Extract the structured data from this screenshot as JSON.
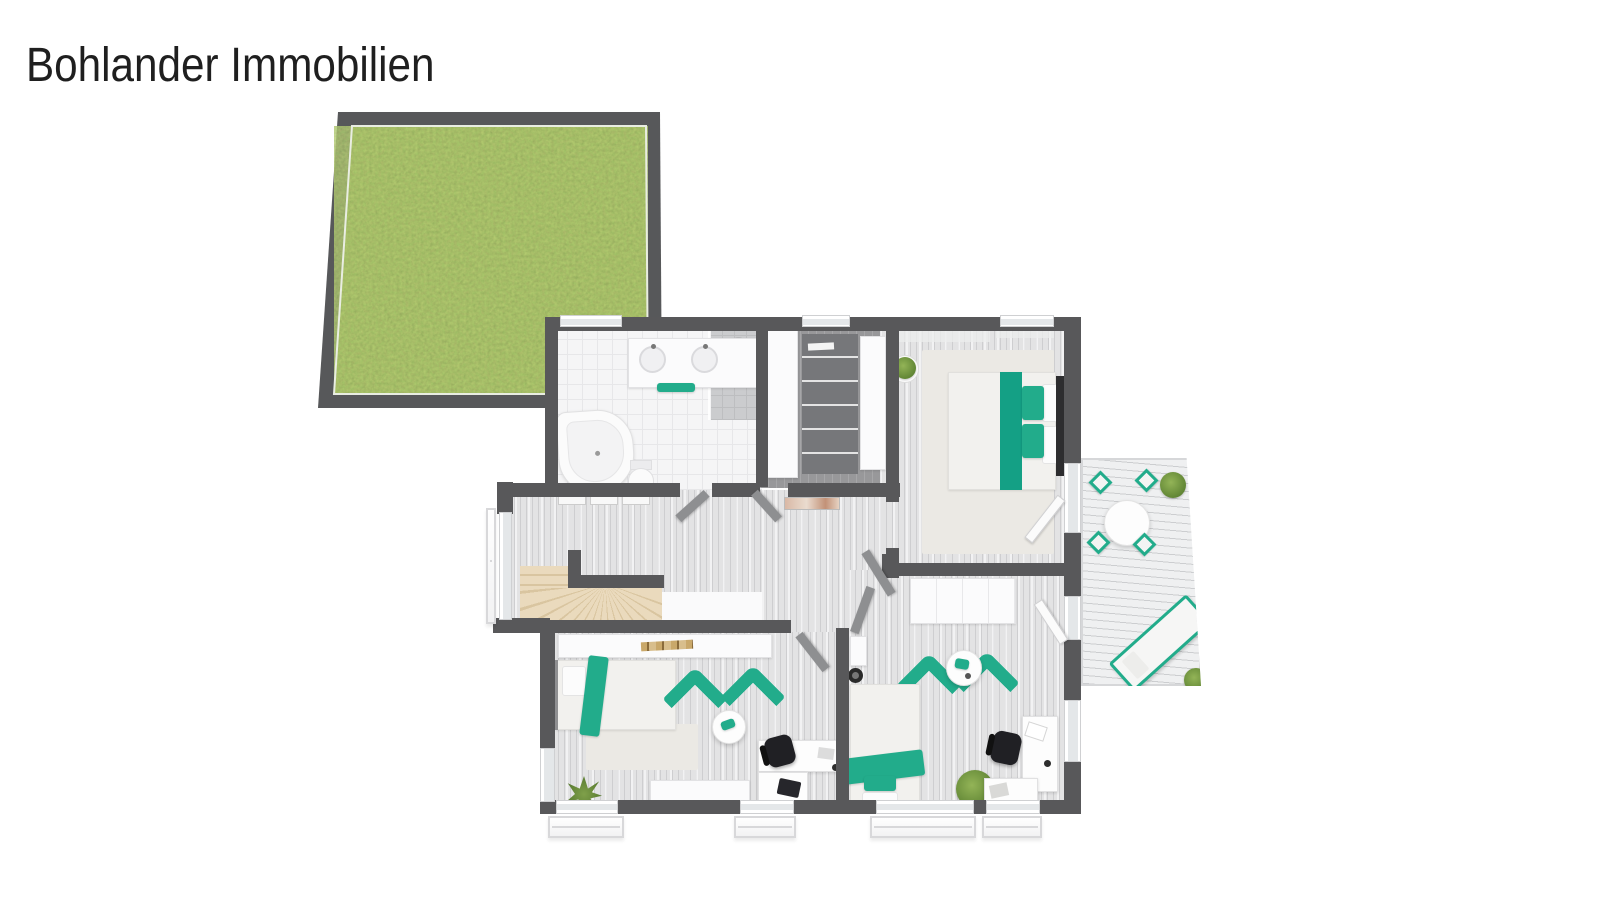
{
  "brand": {
    "name": "Bohlander Immobilien"
  },
  "palette": {
    "accent_teal": "#22AC8B",
    "wall_gray": "#58585A",
    "grass_green": "#7E9447",
    "stair_beige": "#EADABD",
    "floor_light": "#E3E3E4",
    "deck_gray": "#EFF0F1"
  },
  "garden": {
    "label": "lawn-plot"
  },
  "rooms": [
    {
      "name": "bathroom",
      "items": [
        "double-sink-vanity",
        "teal-towel",
        "shower",
        "corner-bathtub",
        "toilet"
      ]
    },
    {
      "name": "walk-in-closet",
      "items": [
        "wardrobe",
        "open-closet",
        "wardrobe"
      ]
    },
    {
      "name": "bedroom",
      "items": [
        "double-bed",
        "teal-runner",
        "pillows",
        "rug",
        "potted-plant",
        "curtains"
      ]
    },
    {
      "name": "hallway-landing",
      "items": [
        "curved-staircase",
        "radiators",
        "wall-picture"
      ]
    },
    {
      "name": "room-bottom-left",
      "items": [
        "sideboard",
        "single-bed",
        "teal-throw",
        "corner-sofa",
        "corner-sofa",
        "coffee-table",
        "desk",
        "office-chair",
        "laptop",
        "sideboard",
        "plant"
      ]
    },
    {
      "name": "room-bottom-right",
      "items": [
        "wardrobe",
        "single-bed",
        "teal-blanket",
        "corner-sofa",
        "corner-sofa",
        "coffee-table",
        "desk",
        "office-chair",
        "papers",
        "plant",
        "wc-niche"
      ]
    }
  ],
  "terrace": {
    "name": "terrace-deck",
    "items": [
      "round-dining-table",
      "dining-chair",
      "dining-chair",
      "dining-chair",
      "dining-chair",
      "sun-lounger",
      "shrub",
      "shrub"
    ]
  }
}
